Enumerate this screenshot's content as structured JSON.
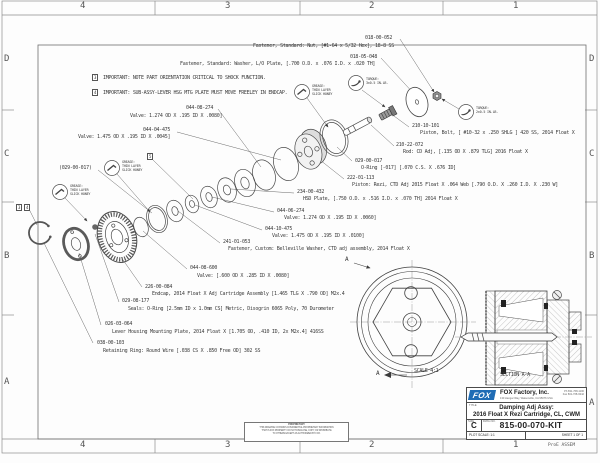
{
  "zones": {
    "cols": [
      "4",
      "3",
      "2",
      "1"
    ],
    "rows": [
      "D",
      "C",
      "B",
      "A"
    ]
  },
  "notes": [
    {
      "ref": "3",
      "text": "IMPORTANT: NOTE PART ORIENTATION CRITICAL TO SHOCK FUNCTION."
    },
    {
      "ref": "4",
      "text": "IMPORTANT: SUB-ASSY-LEVER HSG MTG PLATE MUST MOVE FREELEY IN ENDCAP."
    }
  ],
  "flags": {
    "f3": "3",
    "f4": "4",
    "f5": "5"
  },
  "callouts": [
    {
      "pn": "018-00-052",
      "desc": "Fastener, Standard: Nut, [#1-64 x 5/32 Hex], 18-8 SS"
    },
    {
      "pn": "018-05-048",
      "desc": "Fastener, Standard: Washer, L/O Plate, [.700 O.D. x .076 I.D. x .020 TH]"
    },
    {
      "pn": "210-10-101",
      "desc": "Piston, Bolt, [ #10-32 x .250 SHLG ] 420 SS, 2014 Float X"
    },
    {
      "pn": "210-22-072",
      "desc": "Rod: CD Adj, [.135 OD X .879 TLG] 2016 Float X"
    },
    {
      "pn": "029-00-017",
      "desc": "O-Ring [-017] [.070 C.S. X .676 ID]"
    },
    {
      "pn": "222-01-113",
      "desc": "Piston: Rezi, CTD Adj 2015 Float X .064 Web [.790 O.D. X .260 I.D. X .230 W]"
    },
    {
      "pn": "234-00-432",
      "desc": "HSD Plate, [.750 O.D. x .516 I.D. x .070 TH] 2014 Float X"
    },
    {
      "pn": "044-08-274",
      "desc": "Valve: 1.274 OD X .195 ID X .0080]"
    },
    {
      "pn": "044-04-475",
      "desc": "Valve: 1.475 OD X .195 ID X .0045]"
    },
    {
      "pn": "(029-00-017)",
      "desc": ""
    },
    {
      "pn": "044-06-274",
      "desc": "Valve: 1.274 OD X .195 ID X .0060]"
    },
    {
      "pn": "044-10-475",
      "desc": "Valve: 1.475 OD X .195 ID X .0100]"
    },
    {
      "pn": "241-01-053",
      "desc": "Fastener, Custom: Belleville Washer, CTD adj assembly, 2014 Float X"
    },
    {
      "pn": "044-08-600",
      "desc": "Valve: [.600 OD X .285 ID X .0080]"
    },
    {
      "pn": "226-00-084",
      "desc": "Endcap, 2014 Float X Adj Cartridge Assembly [1.465 TLG X .790 OD] M2x.4"
    },
    {
      "pn": "029-08-177",
      "desc": "Seals: O-Ring [2.5mm ID x 1.0mm CS] Metric, Disogrin 6065 Poly, 70 Durometer"
    },
    {
      "pn": "026-03-064",
      "desc": "Lever Housing Mounting Plate, 2014 Float X [1.705 OD, .410 ID, 2x M2x.4] 416SS"
    },
    {
      "pn": "038-00-103",
      "desc": "Retaining Ring: Round Wire [.038 CS X .850 Free OD] 302 SS"
    }
  ],
  "annotations": {
    "grease": [
      "GREASE:",
      "THIN LAYER",
      "SLICK HONEY"
    ],
    "torque_a": [
      "TORQUE:",
      "3±0.5 IN.LB."
    ],
    "torque_b": [
      "TORQUE:",
      "2±0.5 IN.LB."
    ]
  },
  "views": {
    "front": {
      "arrow": "A",
      "scale": "SCALE  4:1"
    },
    "section": {
      "caption": "SECTION  A-A"
    }
  },
  "title_block": {
    "logo_text": "FOX",
    "company": "FOX Factory, Inc.",
    "address": "130 Hangar Way, Watsonville, CA 95076 USA",
    "phone": "Ph 831-768-1100",
    "fax": "Fax 831-768-9342",
    "title_label": "TITLE",
    "title_line1": "Damping Adj Assy:",
    "title_line2": "2016 Float X Rezi Cartridge, CL, CWM",
    "size_label": "SIZE",
    "size": "C",
    "dwg_label": "DWG.NO.",
    "dwg_no": "815-00-070-KIT",
    "plot_scale_label": "PLOT SCALE:",
    "plot_scale": "1:1",
    "sheet": "SHEET 1 OF 1"
  },
  "footer": {
    "proe": "ProE ASSEM",
    "prop_title": "PROPRIETARY",
    "prop1": "THIS DRAWING CONTAINS CONFIDENTIAL PROPRIETARY INFORMATION",
    "prop2": "THAT IS FOX PROPERTY. DO NOT DISCLOSE, COPY, OR DISTRIBUTE",
    "prop3": "TO OTHERS EXCEPT AS AUTHORIZED BY FOX."
  }
}
